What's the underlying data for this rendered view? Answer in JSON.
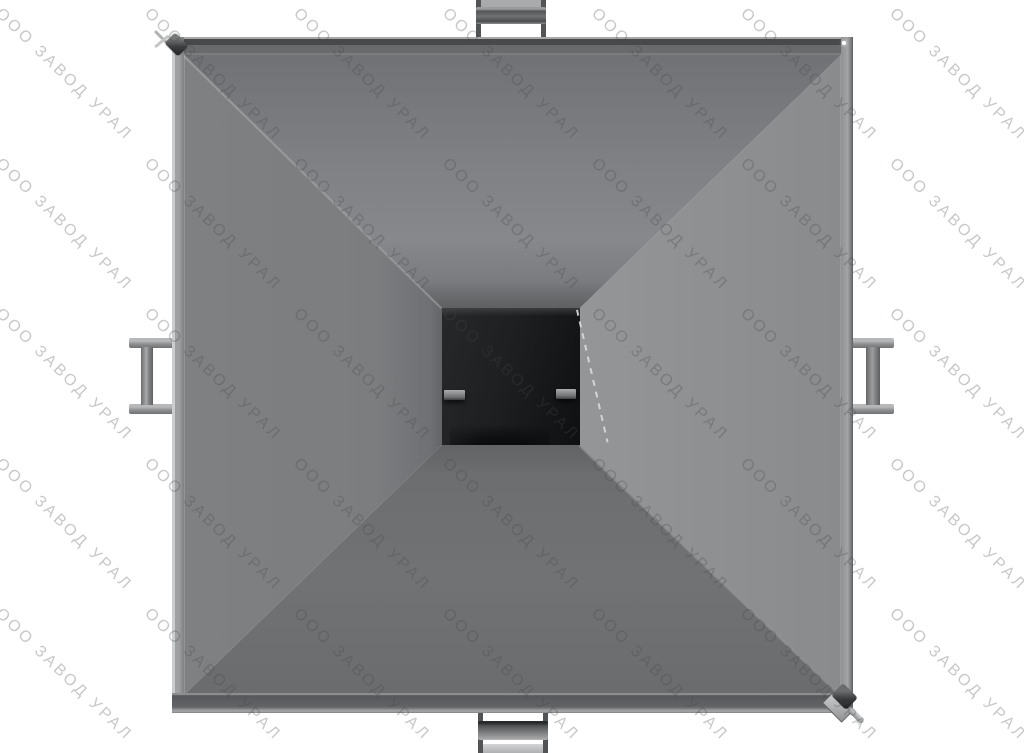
{
  "watermark": {
    "text": "ООО ЗАВОД УРАЛ",
    "color_on_white": "#c8cacb"
  },
  "palette": {
    "background": "#ffffff",
    "face_light": "#929496",
    "face_medium": "#7d7f82",
    "face_dark": "#6a6c6e",
    "rim_dark": "#4b4d4f",
    "rim_highlight": "#cbcdcf",
    "outlet_dark": "#16181a",
    "metal_light": "#b4b6b8",
    "pin_dark": "#333537"
  }
}
